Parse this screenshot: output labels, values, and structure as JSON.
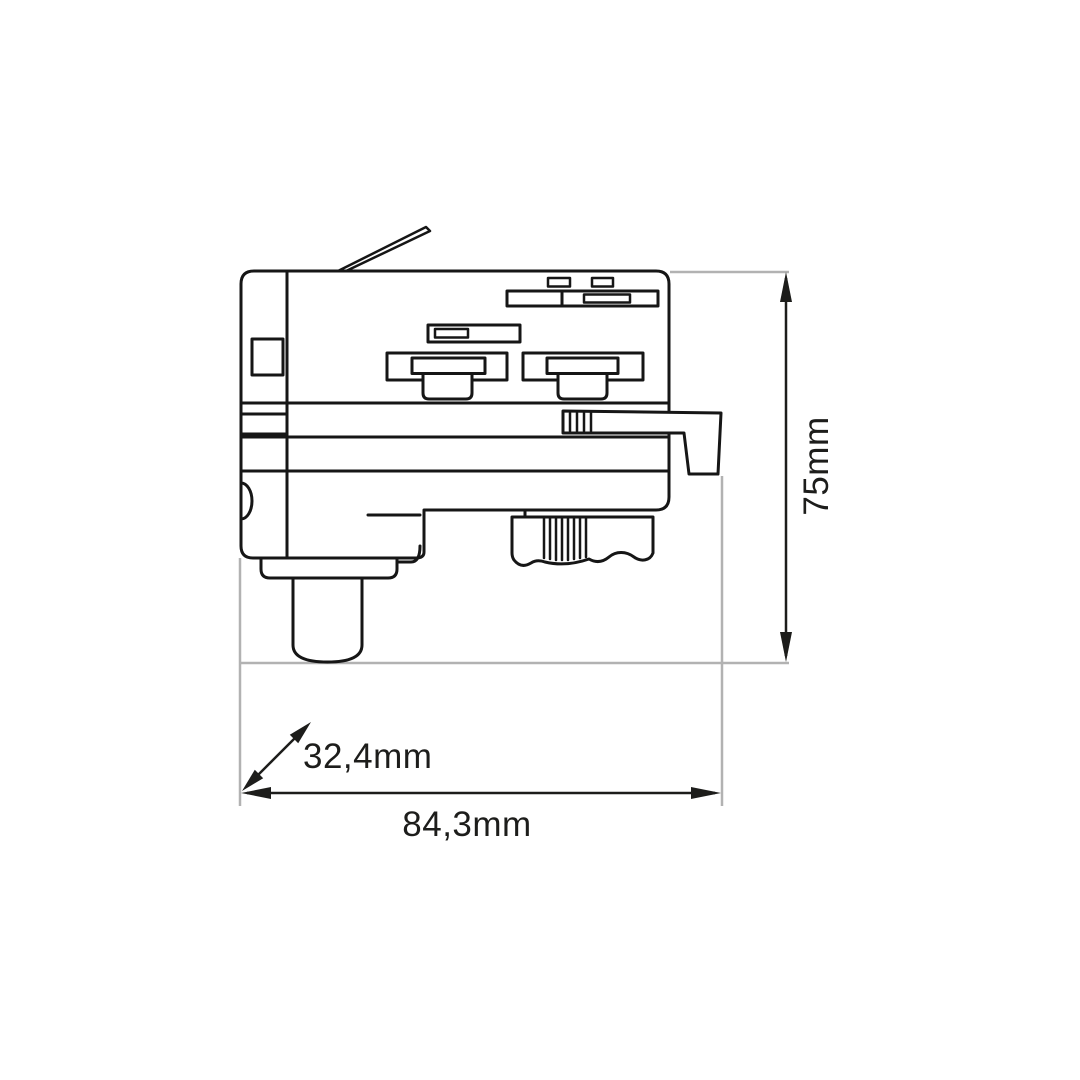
{
  "drawing": {
    "subject": "3-phase track lighting adapter - side view technical dimension drawing",
    "dimension_labels": {
      "height": "75mm",
      "depth": "32,4mm",
      "width": "84,3mm"
    },
    "colors": {
      "outline": "#161616",
      "dimension": "#1d1d1b",
      "reference": "#b2b2b2",
      "background": "#ffffff"
    }
  }
}
